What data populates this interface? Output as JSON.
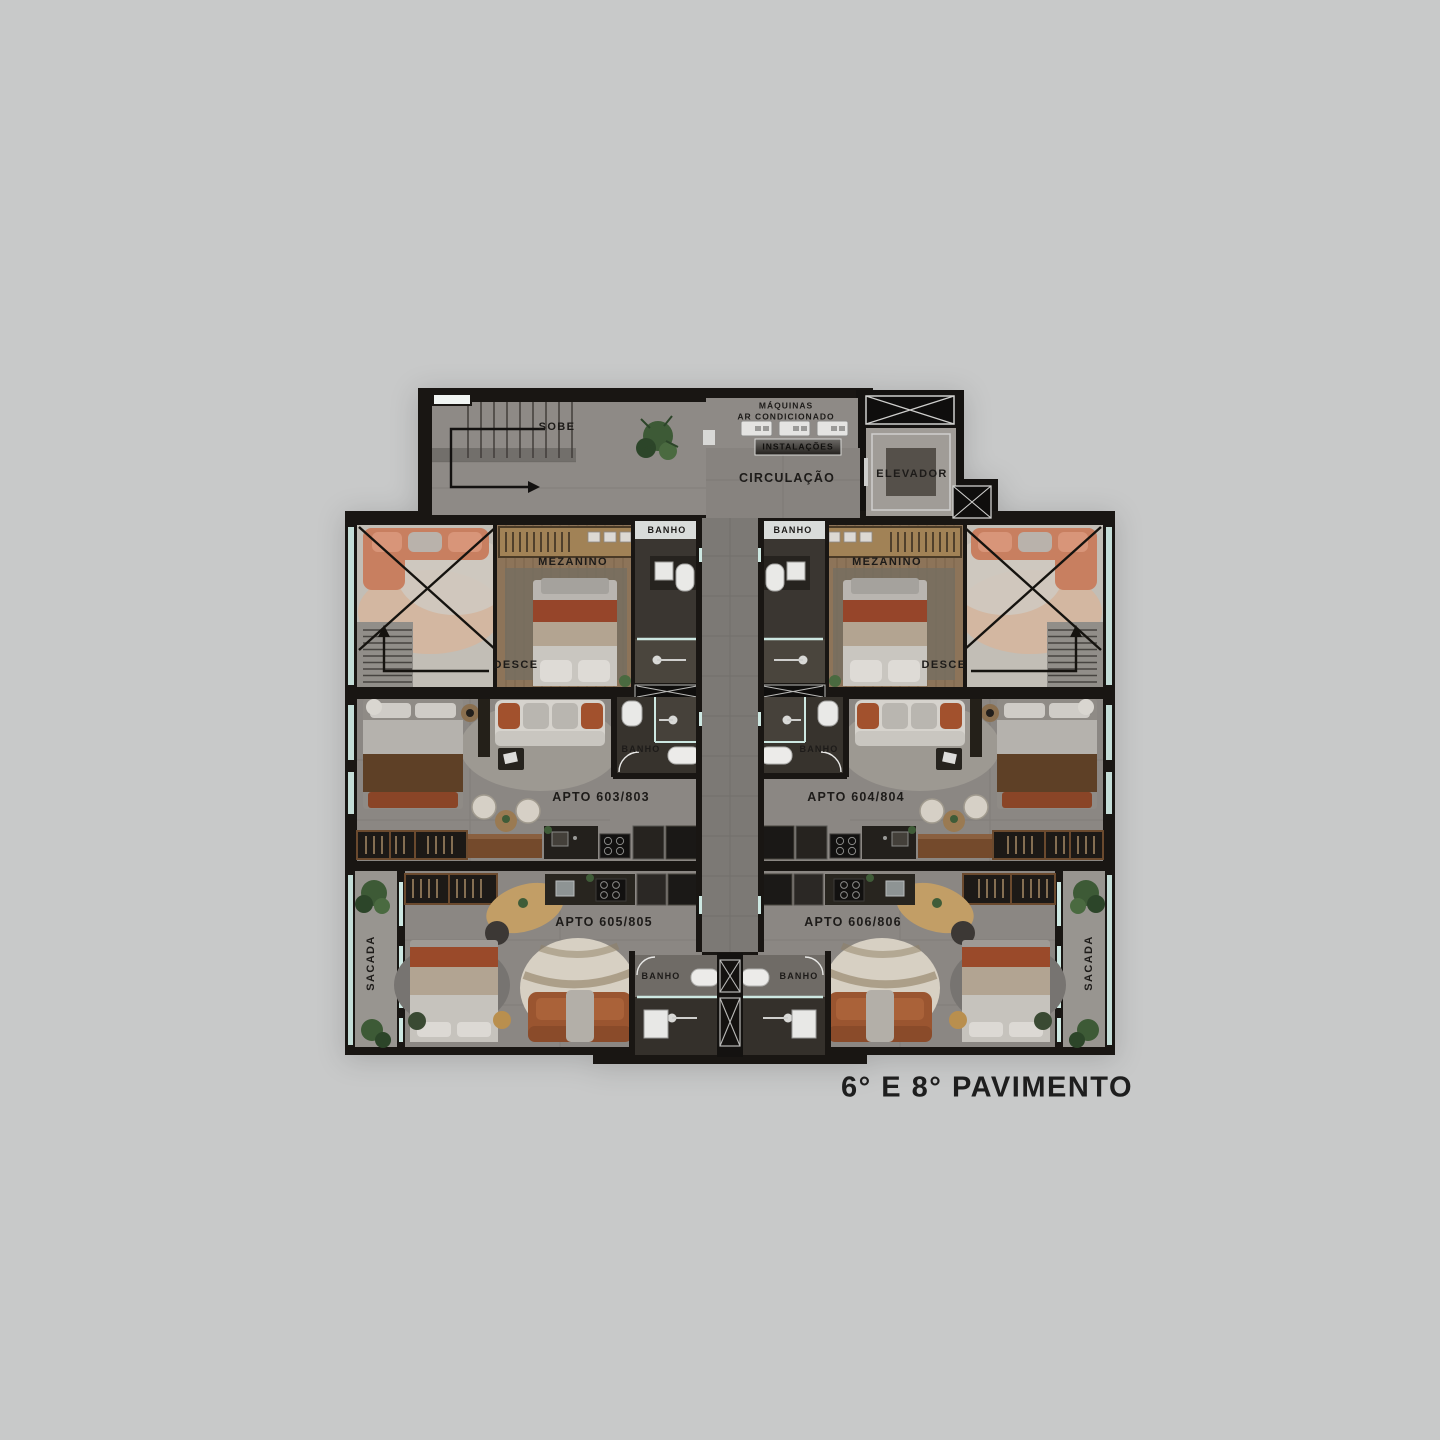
{
  "title": "6° E 8° PAVIMENTO",
  "labels": {
    "stairs_up": "SOBE",
    "stairs_down": "DESCE",
    "machines_line1": "MÁQUINAS",
    "machines_line2": "AR CONDICIONADO",
    "installations": "INSTALAÇÕES",
    "circulation": "CIRCULAÇÃO",
    "elevator": "ELEVADOR",
    "bath": "BANHO",
    "mezzanine": "MEZANINO",
    "balcony": "SACADA"
  },
  "units": [
    {
      "label": "APTO 603/803"
    },
    {
      "label": "APTO 604/804"
    },
    {
      "label": "APTO 605/805"
    },
    {
      "label": "APTO 606/806"
    }
  ],
  "colors": {
    "background": "#c8c9c9",
    "walls": "#191613",
    "floor": "#8b8783",
    "corridor": "#7c7975",
    "mezzanine_wood": "#8d7459",
    "bath_floor": "#3a3630",
    "accent_rust": "#9c4f2e",
    "leather_sofa": "#9a5530",
    "plant_green": "#3d5a36",
    "glass": "#cde8e2",
    "label_text": "#1d1b19"
  }
}
